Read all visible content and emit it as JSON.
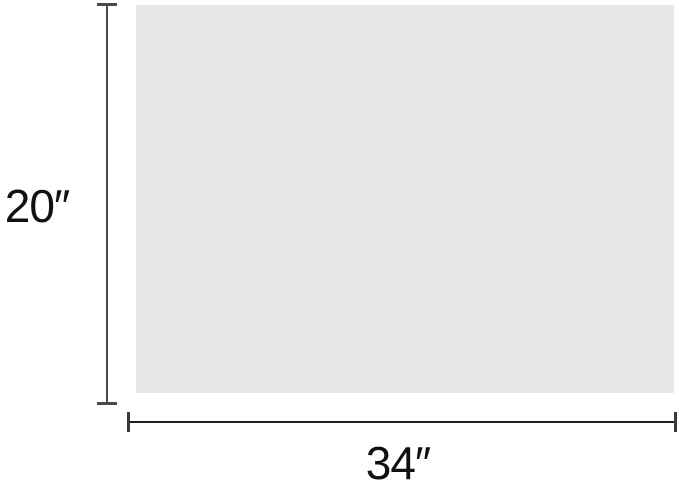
{
  "figure": {
    "type": "product-dimension-diagram",
    "height_dimension": {
      "label": "20″"
    },
    "width_dimension": {
      "label": "34″"
    },
    "colors": {
      "background": "#ffffff",
      "panel_fill": "#e6e7e9",
      "vertical_line": "#4a4a4a",
      "horizontal_line": "#1f1f1f",
      "text": "#111111"
    }
  }
}
